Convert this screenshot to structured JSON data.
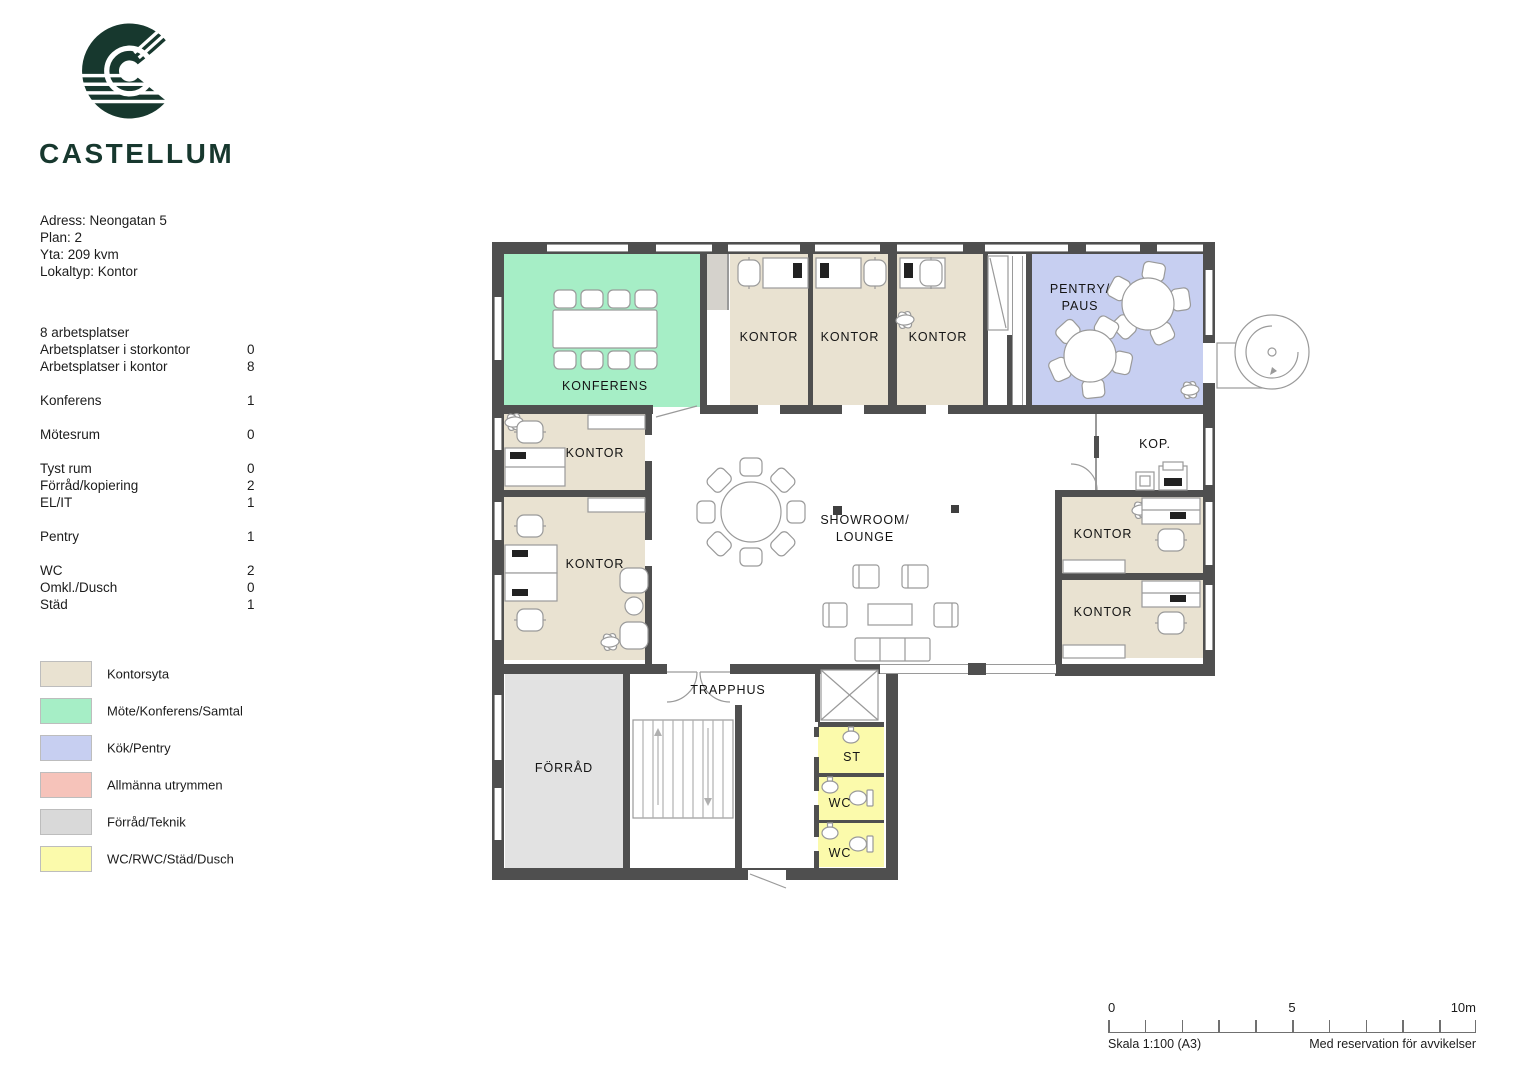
{
  "brand": {
    "name": "CASTELLUM",
    "color": "#17382e"
  },
  "info": {
    "address": "Adress: Neongatan 5",
    "plan": "Plan: 2",
    "area": "Yta: 209 kvm",
    "type": "Lokaltyp: Kontor"
  },
  "stats": {
    "header": "8 arbetsplatser",
    "rows": [
      {
        "label": "Arbetsplatser i storkontor",
        "value": "0"
      },
      {
        "label": "Arbetsplatser i kontor",
        "value": "8"
      },
      {
        "label": "Konferens",
        "value": "1"
      },
      {
        "label": "Mötesrum",
        "value": "0"
      },
      {
        "label": "Tyst rum",
        "value": "0"
      },
      {
        "label": "Förråd/kopiering",
        "value": "2"
      },
      {
        "label": "EL/IT",
        "value": "1"
      },
      {
        "label": "Pentry",
        "value": "1"
      },
      {
        "label": "WC",
        "value": "2"
      },
      {
        "label": "Omkl./Dusch",
        "value": "0"
      },
      {
        "label": "Städ",
        "value": "1"
      }
    ]
  },
  "legend": {
    "items": [
      {
        "label": "Kontorsyta",
        "color": "#e9e2d1"
      },
      {
        "label": "Möte/Konferens/Samtal",
        "color": "#a6eec6"
      },
      {
        "label": "Kök/Pentry",
        "color": "#c7cff1"
      },
      {
        "label": "Allmänna utrymmen",
        "color": "#f6c3ba"
      },
      {
        "label": "Förråd/Teknik",
        "color": "#d9d9d9"
      },
      {
        "label": "WC/RWC/Städ/Dusch",
        "color": "#fbfaab"
      }
    ]
  },
  "colors": {
    "wall": "#4f4f4f",
    "office": "#e9e2d1",
    "meeting": "#a6eec6",
    "pantry": "#c7cff1",
    "storage": "#e2e2e2",
    "closet": "#d5d2cc",
    "wc": "#fbfaab"
  },
  "plan": {
    "labels": {
      "konferens": "KONFERENS",
      "kontor": "KONTOR",
      "pentry_line1": "PENTRY/",
      "pentry_line2": "PAUS",
      "kop": "KOP.",
      "showroom_line1": "SHOWROOM/",
      "showroom_line2": "LOUNGE",
      "forrad": "FÖRRÅD",
      "trapphus": "TRAPPHUS",
      "st": "ST",
      "wc": "WC"
    }
  },
  "scalebar": {
    "tick0": "0",
    "tick5": "5",
    "tick10": "10m",
    "scale": "Skala 1:100 (A3)",
    "disclaimer": "Med reservation för avvikelser"
  }
}
